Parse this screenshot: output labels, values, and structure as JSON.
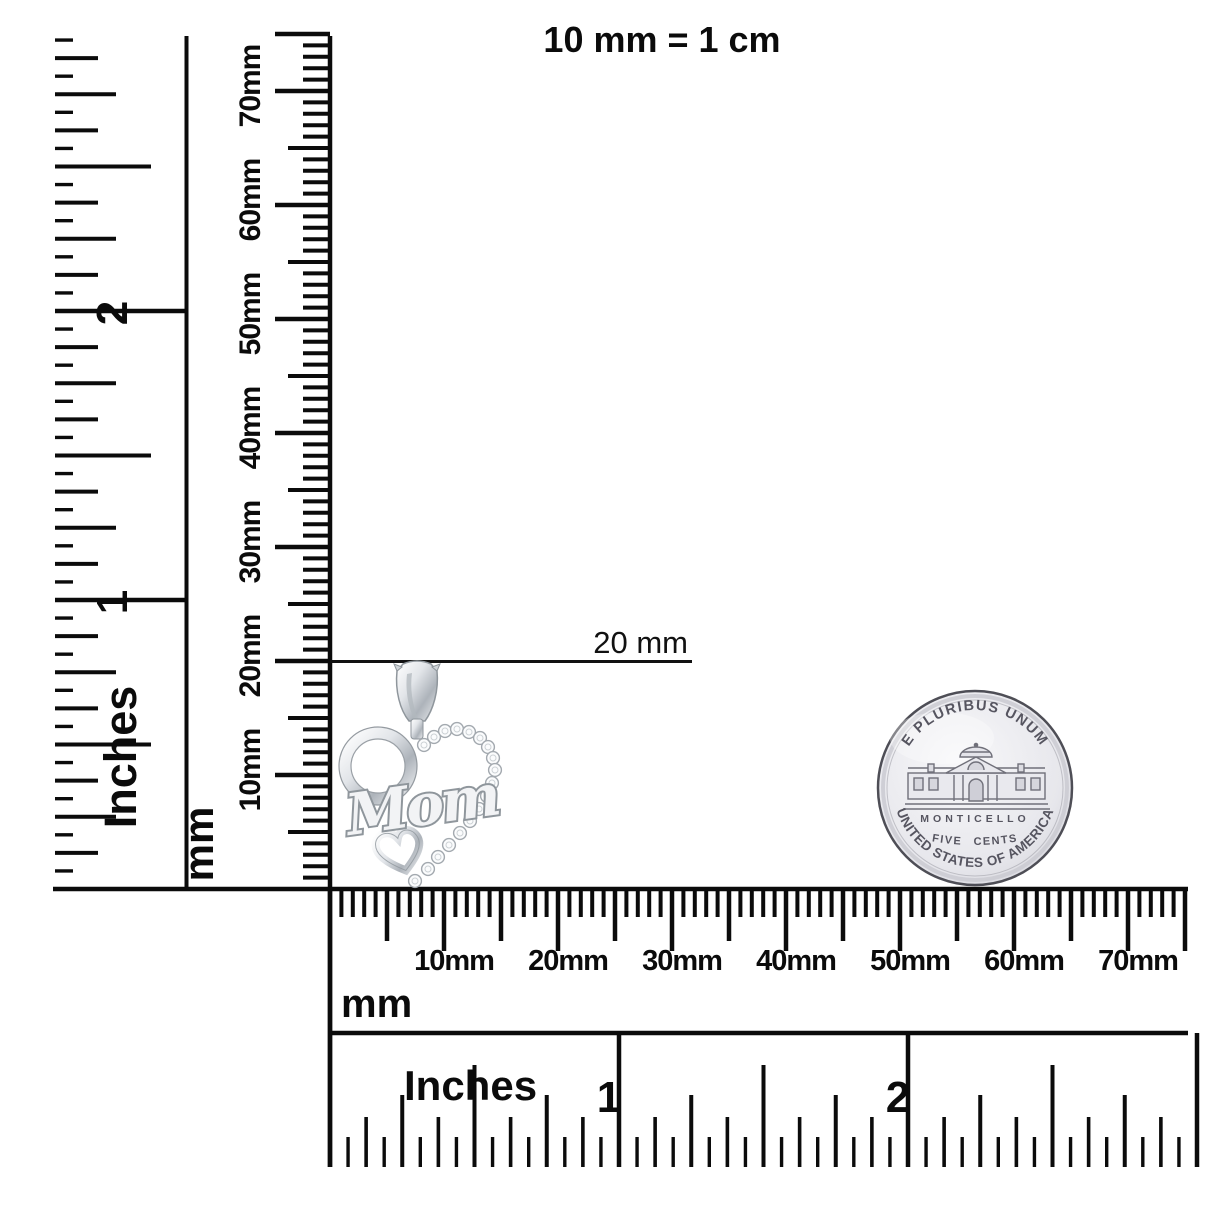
{
  "scale_note": "10 mm = 1 cm",
  "annotation": {
    "label": "20 mm"
  },
  "left_inch_ruler": {
    "unit_label": "Inches",
    "numbers": [
      "2",
      "1"
    ]
  },
  "left_mm_ruler": {
    "unit_label": "mm",
    "tick_labels": [
      "10mm",
      "20mm",
      "30mm",
      "40mm",
      "50mm",
      "60mm",
      "70mm"
    ]
  },
  "bottom_mm_ruler": {
    "unit_label": "mm",
    "tick_labels": [
      "10mm",
      "20mm",
      "30mm",
      "40mm",
      "50mm",
      "60mm",
      "70mm"
    ]
  },
  "bottom_inch_ruler": {
    "unit_label": "Inches",
    "numbers": [
      "1",
      "2"
    ]
  },
  "pendant": {
    "engraving": "Mom"
  },
  "coin": {
    "motto": "E PLURIBUS UNUM",
    "building_label": "MONTICELLO",
    "denomination": "FIVE CENTS",
    "country": "UNITED STATES OF AMERICA"
  },
  "colors": {
    "ink": "#0b0b0b",
    "metal_light": "#f4f5f7",
    "metal_mid": "#c9ced3",
    "metal_dark": "#9aa0a6",
    "coin_face": "#e9e9ee",
    "coin_text": "#565560"
  }
}
